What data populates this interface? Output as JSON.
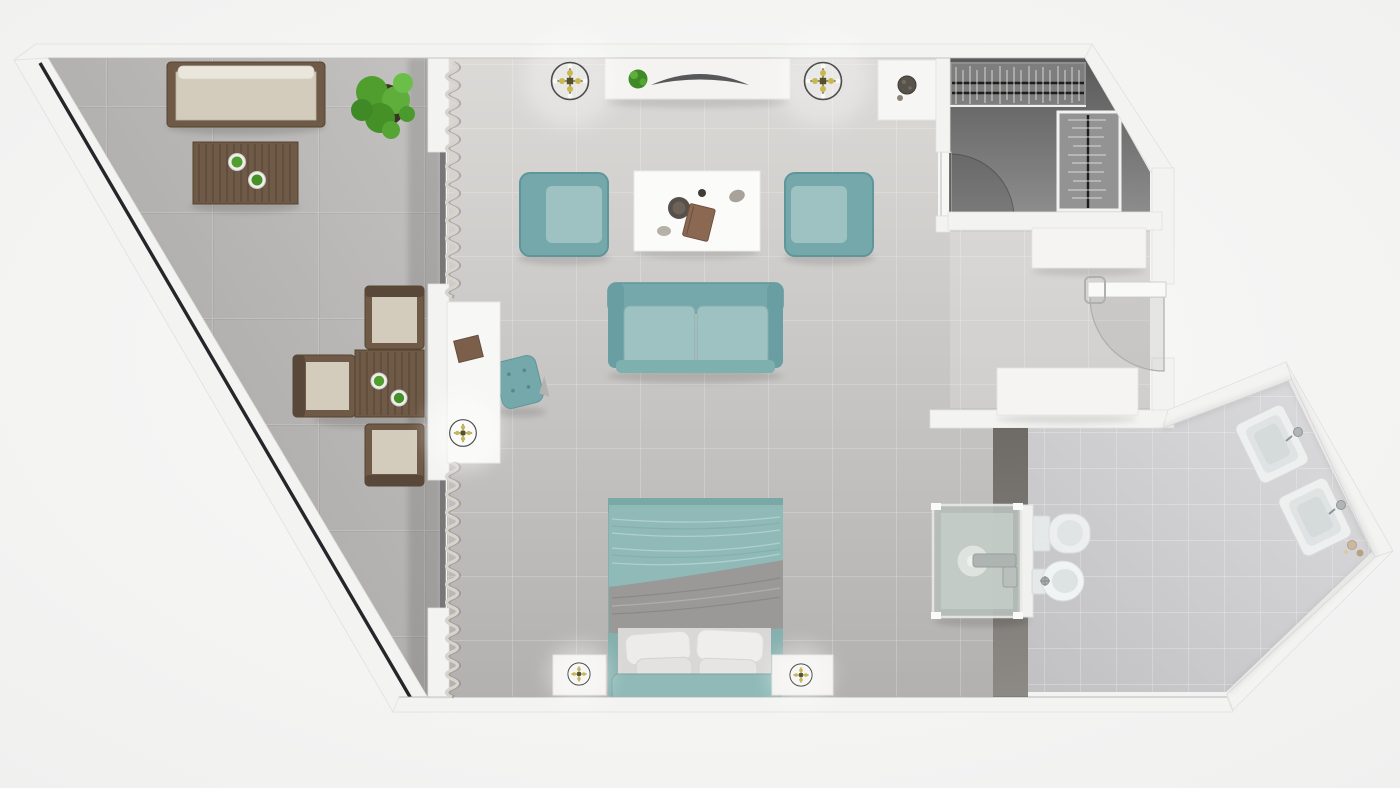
{
  "document": {
    "title": "Hotel suite floor plan — top-down 3D render",
    "type": "3d-floor-plan",
    "visible_text": []
  },
  "palette": {
    "background": "#f7f7f6",
    "wall_white": "#f3f3f2",
    "wall_edge": "#e0e0de",
    "glass_black": "#26262a",
    "balcony_floor": "#b2b0ae",
    "room_floor": "#c8c6c4",
    "bath_floor": "#cfcfd1",
    "closet_floor": "#6f6f6f",
    "divider_wall": "#7d7a76",
    "teal": "#74a8aa",
    "teal_light": "#9ec2c1",
    "teal_bed": "#8fbab8",
    "gray_blanket": "#9b9997",
    "wood": "#6f5947",
    "wood_dark": "#574635",
    "cushion": "#d3cbbc",
    "plant_green": "#4f9e2e",
    "white_furniture": "#f5f4f2",
    "chrome": "#aeb4b2",
    "lamp_gold": "#c9b84e"
  },
  "rooms": [
    {
      "name": "balcony",
      "items": [
        "daybed",
        "slatted coffee table",
        "large potted plant",
        "dining table with two planters",
        "three dining chairs"
      ]
    },
    {
      "name": "living-area",
      "items": [
        "tv console with plant and tv",
        "two teal armchairs",
        "white coffee table with tray and book",
        "teal sofa",
        "teal tufted pouf",
        "window desk with box",
        "side table with plant pot"
      ]
    },
    {
      "name": "bedroom",
      "items": [
        "double bed with teal duvet, gray blanket and four pillows",
        "left nightstand with lamp",
        "right nightstand with lamp"
      ]
    },
    {
      "name": "closet",
      "items": [
        "hanging rail with clothes",
        "second wardrobe rail",
        "closet door"
      ]
    },
    {
      "name": "entry",
      "items": [
        "storage cabinet",
        "entry console",
        "entry door"
      ]
    },
    {
      "name": "bathroom",
      "items": [
        "glass shower cabin",
        "toilet",
        "bidet",
        "two angled sinks with faucets",
        "toiletries"
      ]
    }
  ],
  "symbols": [
    {
      "name": "ceiling-lamp-icon",
      "count": 2
    },
    {
      "name": "desk-lamp-icon",
      "count": 1
    },
    {
      "name": "bedside-lamp-icon",
      "count": 2
    },
    {
      "name": "door-swing-arc",
      "count": 2
    },
    {
      "name": "curtain-zigzag",
      "count": 2
    }
  ]
}
